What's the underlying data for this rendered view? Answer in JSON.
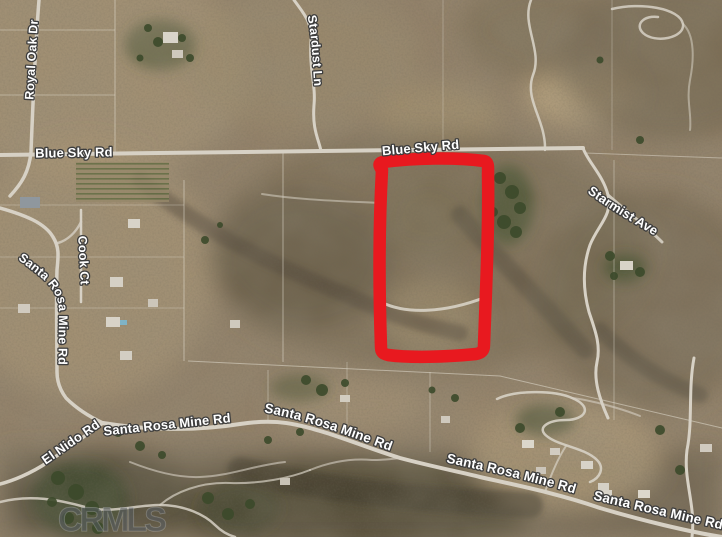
{
  "map": {
    "watermark": "CRMLS",
    "road_labels": {
      "royal_oak_dr": "Royal Oak Dr",
      "blue_sky_rd_west": "Blue Sky Rd",
      "blue_sky_rd_east": "Blue Sky Rd",
      "stardust_ln": "Stardust Ln",
      "starmist_ave": "Starmist Ave",
      "cook_ct": "Cook Ct",
      "santa_rosa_mine_rd_upper_left": "Santa Rosa Mine Rd",
      "el_nido_rd": "El Nido Rd",
      "santa_rosa_mine_rd_lower_1": "Santa Rosa Mine Rd",
      "santa_rosa_mine_rd_lower_2": "Santa Rosa Mine Rd",
      "santa_rosa_mine_rd_lower_3": "Santa Rosa Mine Rd",
      "santa_rosa_mine_rd_lower_4": "Santa Rosa Mine Rd"
    },
    "annotation": {
      "shape": "hand-drawn rectangle outline",
      "color": "#e8191f"
    },
    "colors": {
      "label_fill": "#ffffff",
      "label_outline": "#3d3d3d",
      "road": "#d7d1c5",
      "terrain_base": "#93826a"
    }
  }
}
